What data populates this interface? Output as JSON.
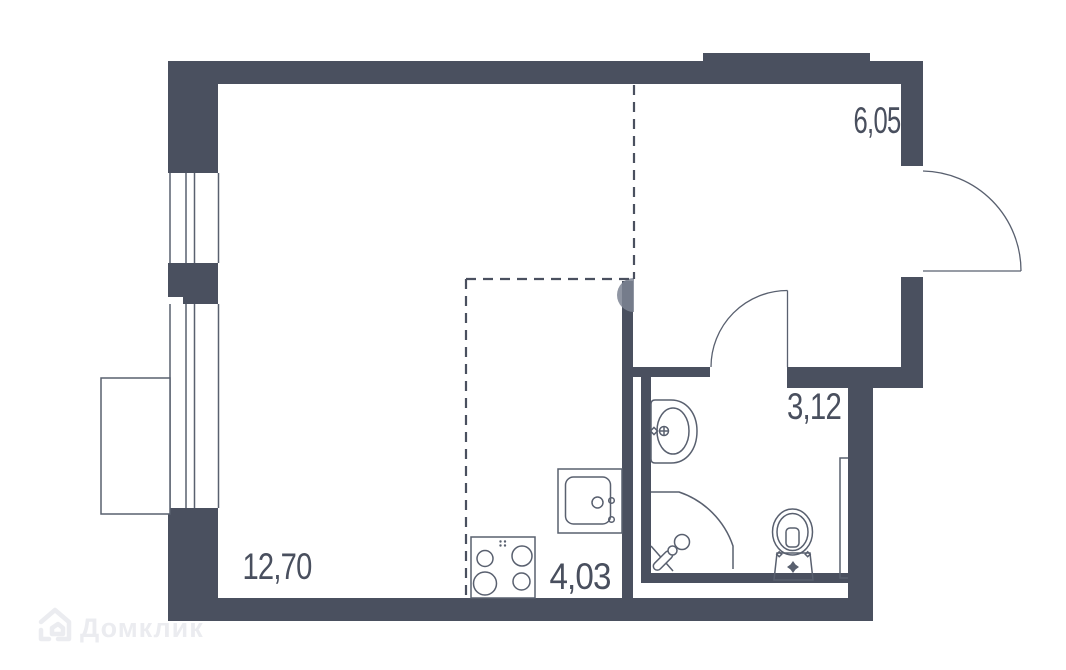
{
  "rooms": [
    {
      "id": "living-room",
      "area": "12,70"
    },
    {
      "id": "hallway",
      "area": "6,05"
    },
    {
      "id": "kitchen-zone",
      "area": "4,03"
    },
    {
      "id": "bathroom",
      "area": "3,12"
    }
  ],
  "fixtures": [
    "stove",
    "kitchen-sink",
    "washbasin",
    "shower",
    "toilet",
    "ventilation-duct"
  ],
  "openings": [
    "entry-door",
    "bathroom-door",
    "window-upper",
    "window-lower",
    "balcony"
  ],
  "watermark": {
    "text": "Домклик",
    "icon": "domclick-house-icon"
  },
  "colors": {
    "wall": "#4a505f",
    "line": "#59606f",
    "dash": "#4a505f",
    "label": "#494f5e",
    "watermark": "#ebecf0",
    "column_cap": "#7d8493"
  }
}
